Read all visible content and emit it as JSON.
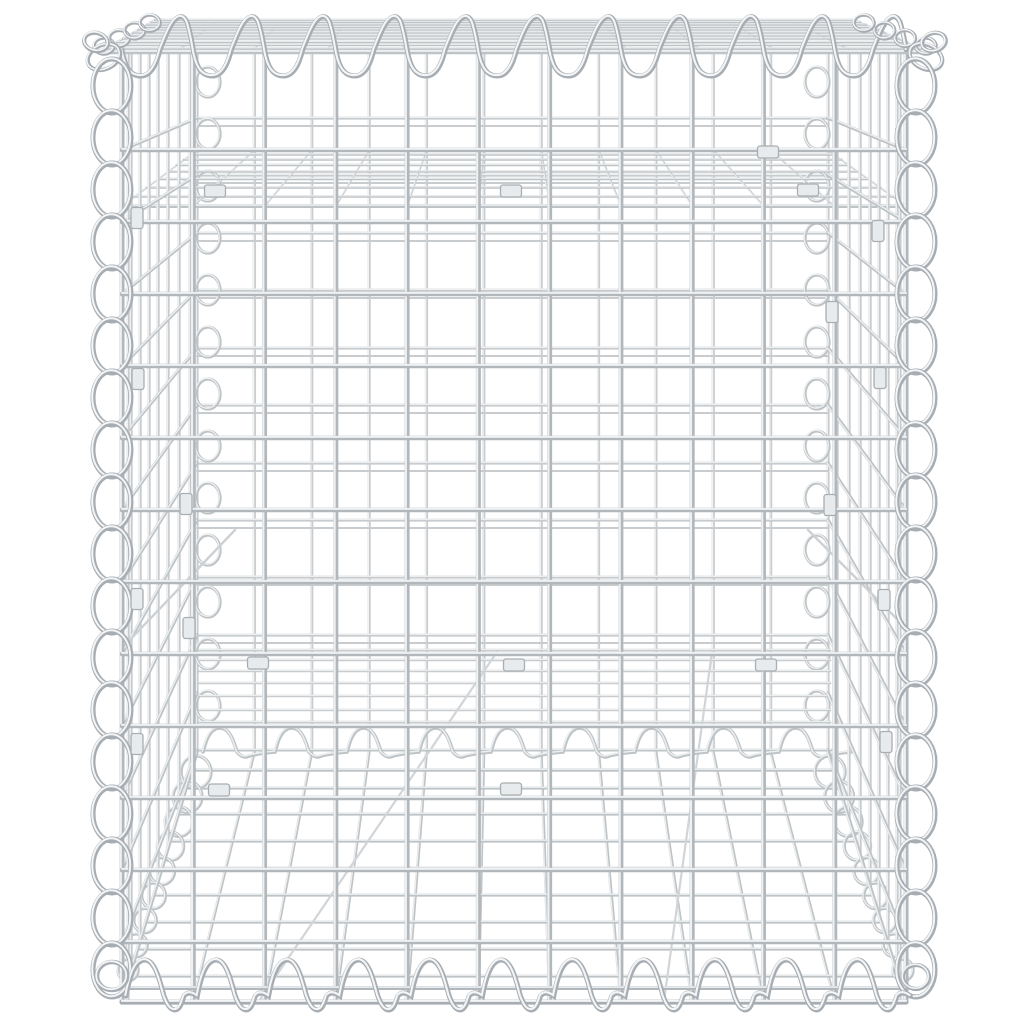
{
  "image": {
    "kind": "product-photo",
    "subject": "Galvanized steel gabion wire mesh basket with spiral edge connectors",
    "background": "#ffffff",
    "width": 1024,
    "height": 1024
  },
  "palette": {
    "wire_front": "#b2b7bb",
    "wire_front_hi": "#eef1f3",
    "wire_edge": "#a7adb2",
    "wire_edge_hi": "#f3f5f6",
    "wire_back": "#c8cccf",
    "wire_back_hi": "#f0f2f3",
    "wire_mid": "#bec3c6",
    "wire_mid_hi": "#edeff1",
    "clip_fill": "#e8ebed",
    "clip_edge": "#a8aeb2"
  },
  "front_panel": {
    "x1": 122,
    "x2": 906,
    "y_top": 48,
    "y_bottom": 1002,
    "n_cols": 12,
    "row_ys": [
      150,
      222,
      294,
      366,
      438,
      510,
      582,
      654,
      726,
      798,
      870,
      942
    ],
    "bottom_wires": [
      988,
      1002
    ],
    "inner_edge_x": [
      128,
      900
    ],
    "w": 5
  },
  "back_panel": {
    "x1": 197,
    "x2": 828,
    "y_top": 52,
    "y_bottom": 750,
    "n_cols": 12,
    "row_ys": [
      118,
      175,
      233,
      290,
      348,
      405,
      463,
      520,
      577,
      635
    ],
    "companion_dy": 8,
    "w": 3.2
  },
  "top_face": {
    "front_y": 52,
    "front_x1": 100,
    "front_x2": 930,
    "back_y": 20,
    "back_x1": 155,
    "back_x2": 855,
    "line_ys": [
      20,
      22,
      24.5,
      27,
      29.5,
      32.5,
      35.5,
      38.5,
      42,
      45,
      48.5,
      52
    ],
    "n_ticks": 12,
    "w_line": 2.6,
    "w_front": 4.5
  },
  "shelf": {
    "front_y": 206,
    "front_x1": 122,
    "front_x2": 906,
    "back_y": 150,
    "back_x1": 197,
    "back_x2": 828,
    "line_ys": [
      150,
      154.5,
      159.5,
      165,
      171.5,
      179,
      187.5,
      196.5,
      206
    ],
    "n_ticks": 12,
    "w_line": 2.6,
    "w_front": 4
  },
  "floor": {
    "front_y": 1001,
    "front_x1": 122,
    "front_x2": 906,
    "back_y": 752,
    "back_x1": 197,
    "back_x2": 828,
    "n_wires": 12,
    "dense_ys": [
      650,
      660,
      671,
      683,
      696,
      710,
      722
    ],
    "strip_ys": [
      788,
      814,
      841,
      868,
      895,
      922,
      949,
      976
    ],
    "junction_ys": [
      750,
      770
    ],
    "diagonals": [
      [
        497,
        652,
        259,
        1001
      ],
      [
        712,
        652,
        664,
        1001
      ]
    ],
    "w": 3
  },
  "left_wall": {
    "verticals_x": [
      131,
      140,
      149,
      158,
      168,
      179,
      190
    ],
    "front_x": 122,
    "back_x": 197,
    "row_front_ys": [
      150,
      222,
      294,
      366,
      438,
      510,
      582,
      654,
      726,
      798,
      870,
      942
    ],
    "row_back_ys": [
      118,
      175,
      233,
      290,
      348,
      405,
      463,
      520,
      577,
      635,
      693,
      750
    ],
    "diagonal": [
      235,
      530,
      125,
      645
    ],
    "w": 3.4
  },
  "right_wall": {
    "verticals_x": [
      897,
      888,
      879,
      870,
      860,
      849,
      837
    ],
    "front_x": 906,
    "back_x": 828,
    "row_front_ys": [
      150,
      222,
      294,
      366,
      438,
      510,
      582,
      654,
      726,
      798,
      870,
      942
    ],
    "row_back_ys": [
      118,
      175,
      233,
      290,
      348,
      405,
      463,
      520,
      577,
      635,
      693,
      750
    ],
    "diagonal": [
      808,
      530,
      903,
      625
    ],
    "w": 3.4
  },
  "spirals": {
    "front_left": {
      "cx": 112,
      "rx": 19,
      "ry": 27,
      "y0": 86,
      "period": 52,
      "count": 18,
      "w": 5
    },
    "front_right": {
      "cx": 916,
      "rx": 19,
      "ry": 27,
      "y0": 86,
      "period": 52,
      "count": 18,
      "w": 5
    },
    "back_left": {
      "cx": 208,
      "rx": 12,
      "ry": 15,
      "y0": 82,
      "period": 52,
      "count": 13,
      "w": 3.3
    },
    "back_right": {
      "cx": 817,
      "rx": 12,
      "ry": 15,
      "y0": 82,
      "period": 52,
      "count": 13,
      "w": 3.3
    },
    "top": {
      "baseline": 50,
      "x0": 122,
      "period": 71.3,
      "count": 11,
      "trough_y": 76,
      "crest_y": 14,
      "w": 5
    },
    "bottom": {
      "baseline": 996,
      "x0": 126,
      "period": 71.3,
      "count": 11,
      "crest_y": 960,
      "descend_y": 1010,
      "w": 5
    },
    "floor_back": {
      "baseline": 752,
      "x0": 203,
      "period": 72,
      "count": 9,
      "crest_y": 728,
      "w": 3.6
    },
    "chain_left": {
      "x1": 196,
      "y1": 772,
      "x2": 128,
      "y2": 970,
      "count": 9,
      "r1": 15,
      "r2": 10,
      "w": 3.4
    },
    "chain_right": {
      "x1": 830,
      "y1": 772,
      "x2": 903,
      "y2": 970,
      "count": 9,
      "r1": 15,
      "r2": 10,
      "w": 3.4
    },
    "top_left_edge": {
      "x1": 104,
      "y1": 46,
      "x2": 150,
      "y2": 23,
      "count": 4,
      "r": 10,
      "w": 3.6
    },
    "top_right_edge": {
      "x1": 926,
      "y1": 46,
      "x2": 864,
      "y2": 23,
      "count": 4,
      "r": 10,
      "w": 3.6
    }
  },
  "corner_knots": {
    "top_left": [
      [
        104,
        57,
        17,
        12,
        -25
      ],
      [
        96,
        42,
        12,
        9,
        15
      ]
    ],
    "top_right": [
      [
        926,
        57,
        17,
        12,
        25
      ],
      [
        934,
        42,
        12,
        9,
        -15
      ]
    ],
    "bottom_left": [
      [
        112,
        976,
        15,
        14,
        0
      ]
    ],
    "bottom_right": [
      [
        916,
        977,
        13,
        12,
        0
      ]
    ]
  },
  "clips": [
    {
      "x": 137,
      "y": 218,
      "o": "v"
    },
    {
      "x": 215,
      "y": 191,
      "o": "h"
    },
    {
      "x": 511,
      "y": 191,
      "o": "h"
    },
    {
      "x": 808,
      "y": 190,
      "o": "h"
    },
    {
      "x": 768,
      "y": 152,
      "o": "h"
    },
    {
      "x": 138,
      "y": 379,
      "o": "v"
    },
    {
      "x": 186,
      "y": 504,
      "o": "v"
    },
    {
      "x": 137,
      "y": 599,
      "o": "v"
    },
    {
      "x": 189,
      "y": 628,
      "o": "v"
    },
    {
      "x": 137,
      "y": 744,
      "o": "v"
    },
    {
      "x": 219,
      "y": 790,
      "o": "h"
    },
    {
      "x": 258,
      "y": 663,
      "o": "h"
    },
    {
      "x": 514,
      "y": 665,
      "o": "h"
    },
    {
      "x": 511,
      "y": 789,
      "o": "h"
    },
    {
      "x": 766,
      "y": 665,
      "o": "h"
    },
    {
      "x": 878,
      "y": 231,
      "o": "v"
    },
    {
      "x": 832,
      "y": 312,
      "o": "v"
    },
    {
      "x": 880,
      "y": 378,
      "o": "v"
    },
    {
      "x": 830,
      "y": 505,
      "o": "v"
    },
    {
      "x": 884,
      "y": 600,
      "o": "v"
    },
    {
      "x": 886,
      "y": 742,
      "o": "v"
    }
  ],
  "clip_size": {
    "long": 21,
    "short": 12
  }
}
